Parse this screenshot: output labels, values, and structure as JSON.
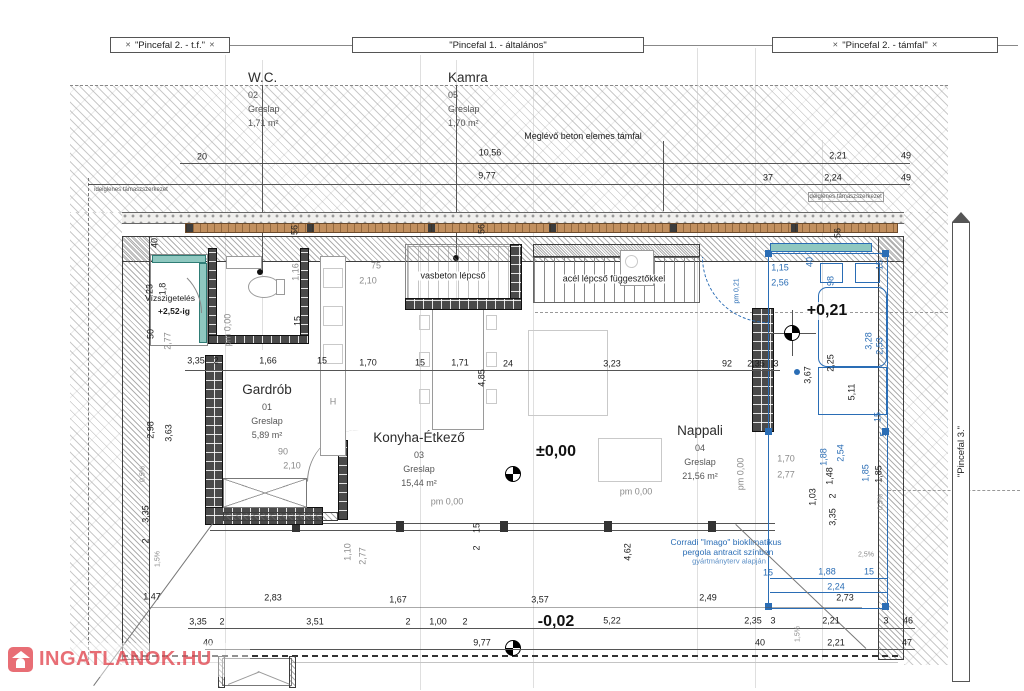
{
  "drawing": {
    "banners": {
      "left": "\"Pincefal 2. - t.f.\"",
      "center": "\"Pincefal 1. - általános\"",
      "right": "\"Pincefal 2. - támfal\"",
      "side": "\"Pincefal 3.\"",
      "end_mark": "✕"
    },
    "rooms": [
      {
        "name": "W.C.",
        "num": "02",
        "floor": "Greslap",
        "area": "1,71 m²"
      },
      {
        "name": "Kamra",
        "num": "05",
        "floor": "Greslap",
        "area": "1,70 m²"
      },
      {
        "name": "Gardrób",
        "num": "01",
        "floor": "Greslap",
        "area": "5,89 m²"
      },
      {
        "name": "Konyha-Étkező",
        "num": "03",
        "floor": "Greslap",
        "area": "15,44 m²"
      },
      {
        "name": "Nappali",
        "num": "04",
        "floor": "Greslap",
        "area": "21,56 m²"
      }
    ],
    "stairs": {
      "concrete": "vasbeton lépcső",
      "steel": "acél lépcső függesztőkkel"
    },
    "notes": {
      "retaining": "Meglévő beton elemes támfal",
      "temp_left": "ideiglenes támaszszerkezet",
      "temp_right": "ideiglenes támaszszerkezet",
      "waterproof1": "Vízszigetelés",
      "waterproof2": "+2,52-ig",
      "pergola1": "Corradi \"Imago\" bioklimatikus",
      "pergola2": "pergola antracit színben",
      "pergola3": "gyártmányterv alapján"
    },
    "levels": {
      "ground": "±0,00",
      "terrace": "+0,21",
      "outside": "-0,02"
    },
    "watermark": {
      "text": "INGATLANOK.HU"
    },
    "colors": {
      "blue": "#2a6db5",
      "teal": "#8fc8c0",
      "wood": "#c2905f",
      "red": "#e4555e"
    },
    "dims": {
      "labels": [
        {
          "t": "20",
          "x": 202,
          "y": 157
        },
        {
          "t": "10,56",
          "x": 490,
          "y": 153
        },
        {
          "t": "2,21",
          "x": 838,
          "y": 156
        },
        {
          "t": "49",
          "x": 906,
          "y": 156
        },
        {
          "t": "9,77",
          "x": 487,
          "y": 176
        },
        {
          "t": "37",
          "x": 768,
          "y": 178
        },
        {
          "t": "2,24",
          "x": 833,
          "y": 178
        },
        {
          "t": "49",
          "x": 906,
          "y": 178
        },
        {
          "t": "40",
          "x": 155,
          "y": 243,
          "r": 1
        },
        {
          "t": "56",
          "x": 295,
          "y": 230,
          "r": 1
        },
        {
          "t": "56",
          "x": 482,
          "y": 229,
          "r": 1
        },
        {
          "t": "56",
          "x": 838,
          "y": 233,
          "r": 1
        },
        {
          "t": "40",
          "x": 810,
          "y": 262,
          "r": 1,
          "c": "b"
        },
        {
          "t": "98",
          "x": 831,
          "y": 281,
          "r": 1,
          "c": "b"
        },
        {
          "t": "15",
          "x": 880,
          "y": 265,
          "r": 1,
          "c": "b"
        },
        {
          "t": "1,15",
          "x": 780,
          "y": 268,
          "c": "b"
        },
        {
          "t": "2,56",
          "x": 780,
          "y": 283,
          "c": "b"
        },
        {
          "t": "pm 0,21",
          "x": 737,
          "y": 291,
          "r": 1,
          "c": "b tiny"
        },
        {
          "t": "23",
          "x": 150,
          "y": 289,
          "r": 1
        },
        {
          "t": "1,8",
          "x": 163,
          "y": 289,
          "r": 1
        },
        {
          "t": "50",
          "x": 151,
          "y": 334,
          "r": 1
        },
        {
          "t": "2,77",
          "x": 168,
          "y": 341,
          "r": 1,
          "c": "g"
        },
        {
          "t": "2,98",
          "x": 151,
          "y": 430,
          "r": 1
        },
        {
          "t": "3,63",
          "x": 169,
          "y": 433,
          "r": 1
        },
        {
          "t": "0,5%",
          "x": 143,
          "y": 474,
          "r": 1,
          "c": "g tiny"
        },
        {
          "t": "3,35",
          "x": 146,
          "y": 514,
          "r": 1
        },
        {
          "t": "2",
          "x": 146,
          "y": 541,
          "r": 1
        },
        {
          "t": "1,5%",
          "x": 158,
          "y": 559,
          "r": 1,
          "c": "g tiny"
        },
        {
          "t": "3,35",
          "x": 196,
          "y": 361
        },
        {
          "t": "2",
          "x": 216,
          "y": 361
        },
        {
          "t": "1,66",
          "x": 268,
          "y": 361
        },
        {
          "t": "15",
          "x": 322,
          "y": 361
        },
        {
          "t": "1,70",
          "x": 368,
          "y": 363
        },
        {
          "t": "15",
          "x": 420,
          "y": 363
        },
        {
          "t": "1,71",
          "x": 460,
          "y": 363
        },
        {
          "t": "24",
          "x": 508,
          "y": 364
        },
        {
          "t": "3,23",
          "x": 612,
          "y": 364
        },
        {
          "t": "92",
          "x": 727,
          "y": 364
        },
        {
          "t": "2,35",
          "x": 756,
          "y": 364
        },
        {
          "t": "3",
          "x": 776,
          "y": 364
        },
        {
          "t": "4,85",
          "x": 482,
          "y": 378,
          "r": 1
        },
        {
          "t": "75",
          "x": 376,
          "y": 266,
          "c": "g"
        },
        {
          "t": "2,10",
          "x": 368,
          "y": 281,
          "c": "g"
        },
        {
          "t": "15",
          "x": 298,
          "y": 321,
          "r": 1
        },
        {
          "t": "1,16",
          "x": 296,
          "y": 272,
          "r": 1,
          "c": "g"
        },
        {
          "t": "90",
          "x": 283,
          "y": 452,
          "c": "g"
        },
        {
          "t": "2,10",
          "x": 292,
          "y": 466,
          "c": "g"
        },
        {
          "t": "1,10",
          "x": 348,
          "y": 552,
          "r": 1,
          "c": "g"
        },
        {
          "t": "2,77",
          "x": 363,
          "y": 556,
          "r": 1,
          "c": "g"
        },
        {
          "t": "pm 0,00",
          "x": 228,
          "y": 330,
          "r": 1,
          "c": "g"
        },
        {
          "t": "pm 0,00",
          "x": 447,
          "y": 502,
          "c": "g"
        },
        {
          "t": "15",
          "x": 477,
          "y": 528,
          "r": 1
        },
        {
          "t": "2",
          "x": 477,
          "y": 548,
          "r": 1
        },
        {
          "t": "H",
          "x": 333,
          "y": 402,
          "c": "g"
        },
        {
          "t": "pm 0,00",
          "x": 741,
          "y": 474,
          "r": 1,
          "c": "g"
        },
        {
          "t": "pm 0,00",
          "x": 636,
          "y": 492,
          "c": "g"
        },
        {
          "t": "3,67",
          "x": 808,
          "y": 375,
          "r": 1
        },
        {
          "t": "2,25",
          "x": 831,
          "y": 363,
          "r": 1
        },
        {
          "t": "5,11",
          "x": 852,
          "y": 392,
          "r": 1
        },
        {
          "t": "3,28",
          "x": 869,
          "y": 341,
          "r": 1,
          "c": "b"
        },
        {
          "t": "2,53",
          "x": 880,
          "y": 346,
          "r": 1,
          "c": "b"
        },
        {
          "t": "15",
          "x": 878,
          "y": 417,
          "r": 1,
          "c": "b"
        },
        {
          "t": "5",
          "x": 884,
          "y": 434,
          "r": 1,
          "c": "b"
        },
        {
          "t": "1,88",
          "x": 824,
          "y": 457,
          "r": 1,
          "c": "b"
        },
        {
          "t": "2,54",
          "x": 841,
          "y": 453,
          "r": 1,
          "c": "b"
        },
        {
          "t": "1,48",
          "x": 830,
          "y": 476,
          "r": 1
        },
        {
          "t": "1,70",
          "x": 786,
          "y": 459,
          "c": "g"
        },
        {
          "t": "2,77",
          "x": 786,
          "y": 475,
          "c": "g"
        },
        {
          "t": "1,03",
          "x": 813,
          "y": 497,
          "r": 1
        },
        {
          "t": "1,85",
          "x": 866,
          "y": 473,
          "r": 1,
          "c": "b"
        },
        {
          "t": "1,85",
          "x": 879,
          "y": 474,
          "r": 1
        },
        {
          "t": "2",
          "x": 833,
          "y": 496,
          "r": 1
        },
        {
          "t": "3,35",
          "x": 833,
          "y": 517,
          "r": 1
        },
        {
          "t": "0,5%",
          "x": 881,
          "y": 502,
          "r": 1,
          "c": "g tiny"
        },
        {
          "t": "4,62",
          "x": 628,
          "y": 552,
          "r": 1
        },
        {
          "t": "2,5%",
          "x": 866,
          "y": 555,
          "c": "g tiny"
        },
        {
          "t": "15",
          "x": 768,
          "y": 573,
          "c": "b"
        },
        {
          "t": "1,88",
          "x": 827,
          "y": 572,
          "c": "b"
        },
        {
          "t": "15",
          "x": 869,
          "y": 572,
          "c": "b"
        },
        {
          "t": "2,24",
          "x": 836,
          "y": 587,
          "c": "b"
        },
        {
          "t": "1,5%",
          "x": 798,
          "y": 634,
          "r": 1,
          "c": "g tiny"
        },
        {
          "t": "1,47",
          "x": 152,
          "y": 597
        },
        {
          "t": "2,83",
          "x": 273,
          "y": 598
        },
        {
          "t": "1,67",
          "x": 398,
          "y": 600
        },
        {
          "t": "3,57",
          "x": 540,
          "y": 600
        },
        {
          "t": "2,49",
          "x": 708,
          "y": 598
        },
        {
          "t": "2,73",
          "x": 845,
          "y": 598
        },
        {
          "t": "3,35",
          "x": 198,
          "y": 622
        },
        {
          "t": "2",
          "x": 222,
          "y": 622
        },
        {
          "t": "3,51",
          "x": 315,
          "y": 622
        },
        {
          "t": "2",
          "x": 408,
          "y": 622
        },
        {
          "t": "1,00",
          "x": 438,
          "y": 622
        },
        {
          "t": "2",
          "x": 465,
          "y": 622
        },
        {
          "t": "5,22",
          "x": 612,
          "y": 621
        },
        {
          "t": "2,35",
          "x": 753,
          "y": 621
        },
        {
          "t": "3",
          "x": 773,
          "y": 621
        },
        {
          "t": "2,21",
          "x": 831,
          "y": 621
        },
        {
          "t": "3",
          "x": 886,
          "y": 621
        },
        {
          "t": "46",
          "x": 908,
          "y": 621
        },
        {
          "t": "40",
          "x": 208,
          "y": 643
        },
        {
          "t": "9,77",
          "x": 482,
          "y": 643
        },
        {
          "t": "40",
          "x": 760,
          "y": 643
        },
        {
          "t": "2,21",
          "x": 836,
          "y": 643
        },
        {
          "t": "47",
          "x": 907,
          "y": 643
        }
      ]
    }
  }
}
